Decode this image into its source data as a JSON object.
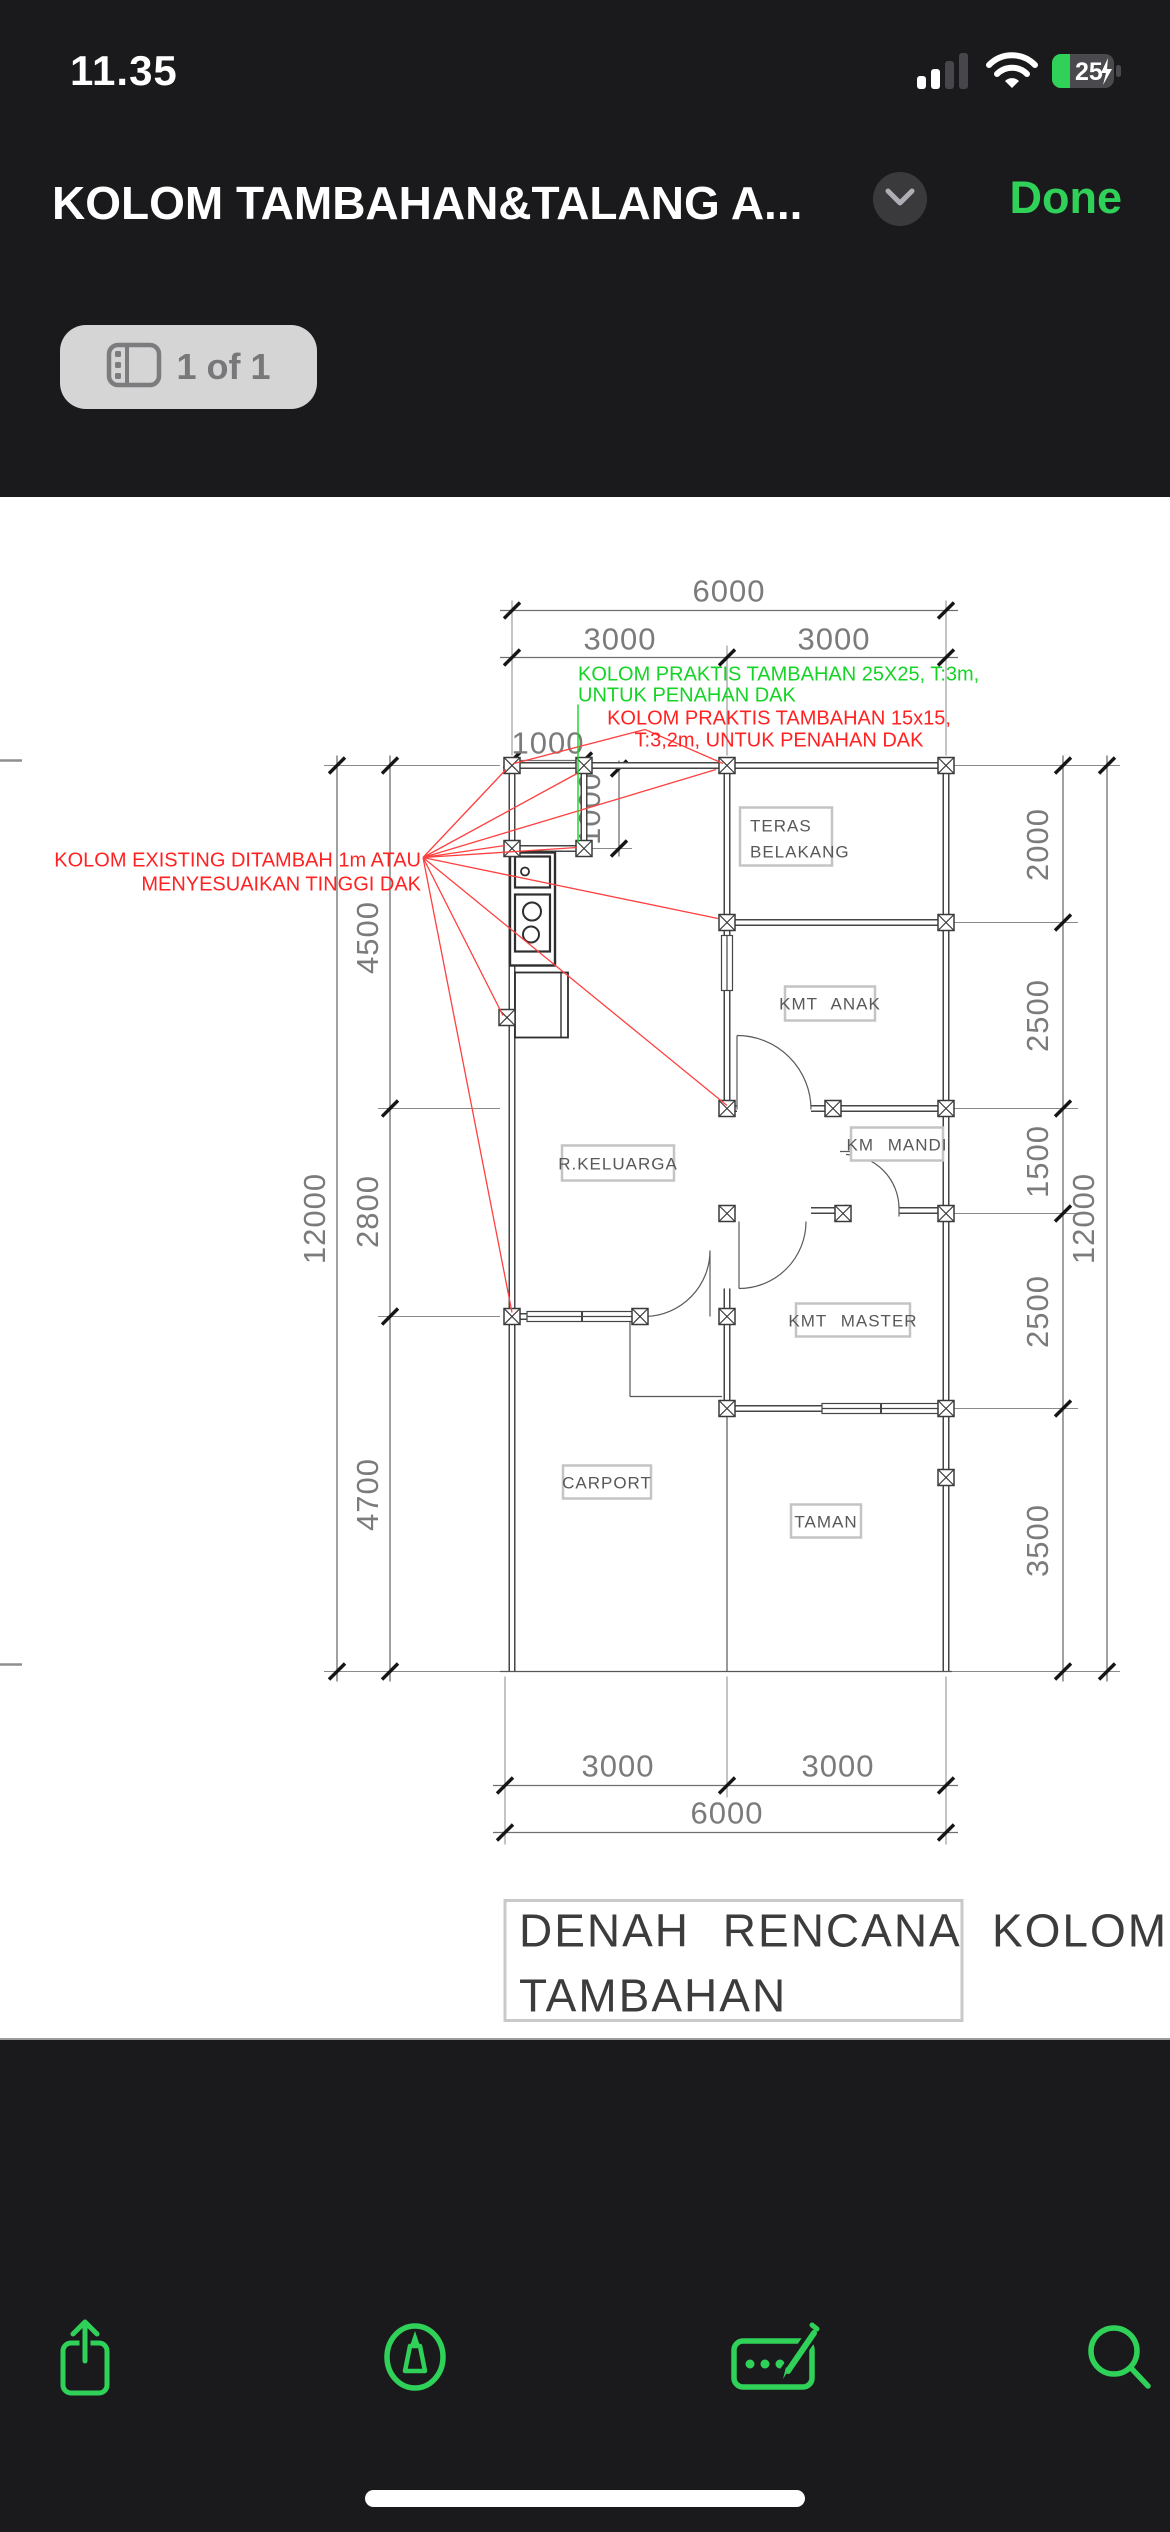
{
  "status_bar": {
    "time": "11.35",
    "battery_percent": "25"
  },
  "nav_bar": {
    "title": "KOLOM TAMBAHAN&TALANG A...",
    "done_label": "Done"
  },
  "page_indicator": {
    "label": "1 of 1"
  },
  "drawing": {
    "caption_line1": "DENAH RENCANA KOLOM",
    "caption_line2": "TAMBAHAN",
    "rooms": {
      "teras_l1": "TERAS",
      "teras_l2": "BELAKANG",
      "kmt_anak": "KMT ANAK",
      "km_mandi": "KM MANDI",
      "r_keluarga": "R.KELUARGA",
      "kmt_master": "KMT MASTER",
      "carport": "CARPORT",
      "taman": "TAMAN"
    },
    "annotations": {
      "green_l1": "KOLOM PRAKTIS TAMBAHAN 25X25, T:3m,",
      "green_l2": "UNTUK PENAHAN DAK",
      "red_top_l1": "KOLOM PRAKTIS TAMBAHAN 15x15,",
      "red_top_l2": "T:3,2m, UNTUK PENAHAN DAK",
      "red_left_l1": "KOLOM EXISTING DITAMBAH 1m ATAU",
      "red_left_l2": "MENYESUAIKAN TINGGI DAK"
    },
    "dims": {
      "top_overall": "6000",
      "top_half_1": "3000",
      "top_half_2": "3000",
      "top_offset": "1000",
      "top_offset_v": "1000",
      "right": [
        "2000",
        "2500",
        "1500",
        "2500",
        "3500"
      ],
      "right_overall": "12000",
      "left": [
        "4500",
        "2800",
        "4700"
      ],
      "left_overall": "12000",
      "bottom_half_1": "3000",
      "bottom_half_2": "3000",
      "bottom_overall": "6000"
    },
    "colors": {
      "accent_green": "#30d158",
      "annotation_red": "#ff2222",
      "annotation_green": "#15d426"
    }
  }
}
